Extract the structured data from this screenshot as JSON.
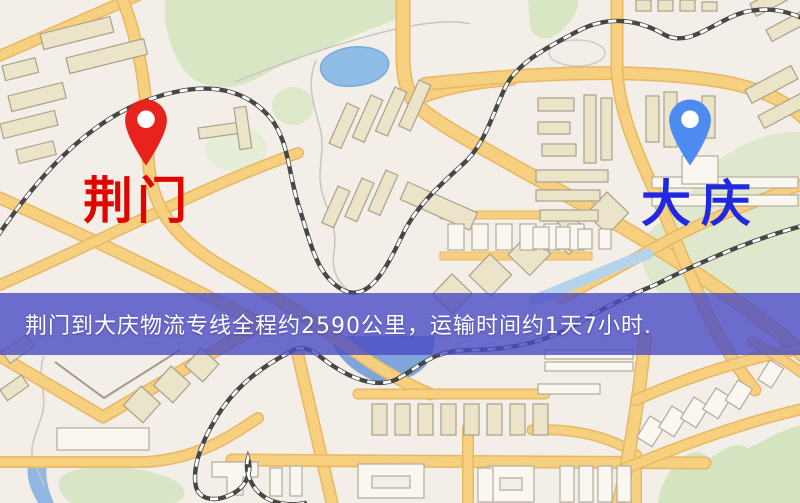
{
  "banner": {
    "text": "荆门到大庆物流专线全程约2590公里，运输时间约1天7小时.",
    "background_color": "#4a4bc4",
    "text_color": "#ffffff"
  },
  "labels": {
    "origin": "荆门",
    "destination": "大庆"
  },
  "pins": {
    "origin": {
      "color": "#e8231c"
    },
    "destination": {
      "color": "#4d8bf0"
    }
  },
  "map_colors": {
    "background": "#f3efe8",
    "road_fill": "#f7d07f",
    "road_casing": "#e7b763",
    "green_area": "#d9e6c3",
    "water": "#7fa5db",
    "building_fill": "#ece4c9",
    "railway": "#474747",
    "origin_label_color": "#e10500",
    "destination_label_color": "#2129e0"
  }
}
